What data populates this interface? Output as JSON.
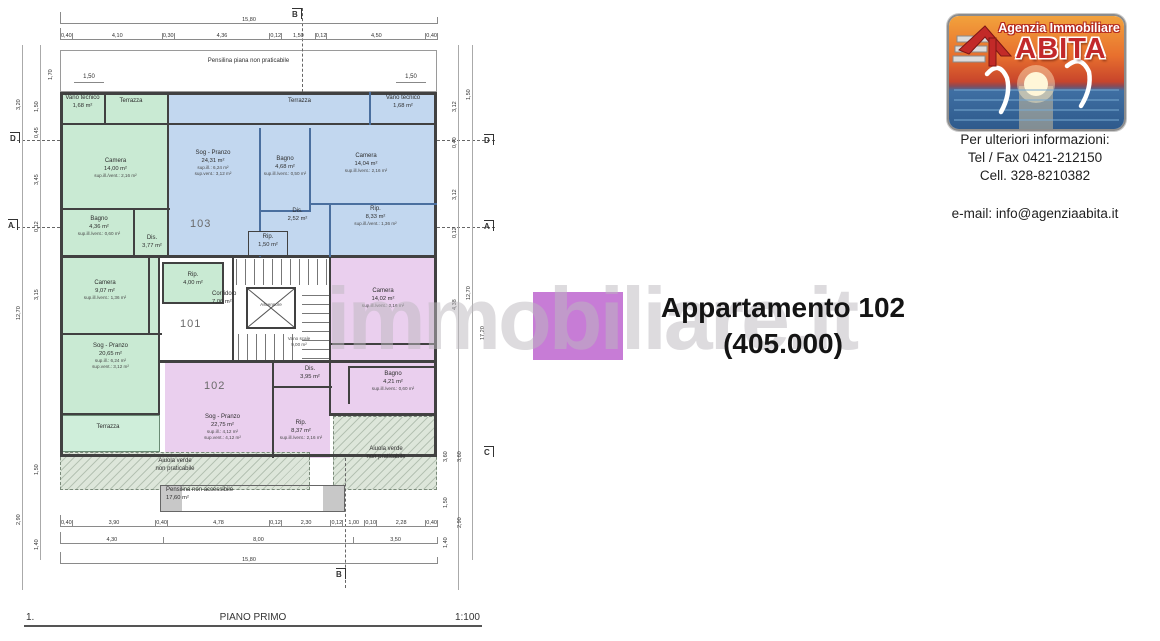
{
  "watermark": "immobiliare.it",
  "listing": {
    "title": "Appartamento 102",
    "price": "(405.000)",
    "swatch_color": "#c77cd6"
  },
  "agency": {
    "name_line1": "Agenzia Immobiliare",
    "name_line2": "ABITA",
    "info_heading": "Per ulteriori informazioni:",
    "phone": "Tel / Fax 0421-212150",
    "mobile": "Cell. 328-8210382",
    "email": "e-mail: info@agenziaabita.it"
  },
  "titleblock": {
    "index": "1.",
    "title": "PIANO PRIMO",
    "scale": "1:100"
  },
  "plan": {
    "colors": {
      "apartment_101": "#c9ead3",
      "apartment_102": "#eacfee",
      "apartment_103": "#c2d7ef",
      "terrace": "#cfeeda",
      "green_area": "#dde6da"
    },
    "apt_numbers": {
      "n101": "101",
      "n102": "102",
      "n103": "103"
    },
    "rooms": [
      {
        "n": "Vano tecnico",
        "a": "1,68 m²"
      },
      {
        "n": "Terrazza"
      },
      {
        "n": "Camera",
        "a": "14,00 m²",
        "s1": "sup.ill./vent.: 2,16 m²"
      },
      {
        "n": "Bagno",
        "a": "4,36 m²",
        "s1": "sup.ill./vent.: 0,60 m²"
      },
      {
        "n": "Dis.",
        "a": "3,77 m²"
      },
      {
        "n": "Camera",
        "a": "9,07 m²",
        "s1": "sup.ill./vent.: 1,36 m²"
      },
      {
        "n": "Rip.",
        "a": "4,00 m²"
      },
      {
        "n": "Sog - Pranzo",
        "a": "20,65 m²",
        "s1": "sup.ill.: 6,24 m²",
        "s2": "sup.vent.: 3,12 m²"
      },
      {
        "n": "Terrazza"
      },
      {
        "n": "Terrazza"
      },
      {
        "n": "Vano tecnico",
        "a": "1,68 m²"
      },
      {
        "n": "Sog - Pranzo",
        "a": "24,31 m²",
        "s1": "sup.ill.: 6,24 m²",
        "s2": "sup.vent.: 3,12 m²"
      },
      {
        "n": "Bagno",
        "a": "4,68 m²",
        "s1": "sup.ill./vent.: 0,50 m²"
      },
      {
        "n": "Camera",
        "a": "14,04 m²",
        "s1": "sup.ill./vent.: 2,16 m²"
      },
      {
        "n": "Dis.",
        "a": "2,52 m²"
      },
      {
        "n": "Rip.",
        "a": "8,33 m²",
        "s1": "sup.ill./vent.: 1,36 m²"
      },
      {
        "n": "Rip.",
        "a": "1,50 m²"
      },
      {
        "n": "Camera",
        "a": "14,02 m²",
        "s1": "sup.ill./vent.: 2,16 m²"
      },
      {
        "n": "Dis.",
        "a": "3,95 m²"
      },
      {
        "n": "Bagno",
        "a": "4,21 m²",
        "s1": "sup.ill./vent.: 0,60 m²"
      },
      {
        "n": "Sog - Pranzo",
        "a": "22,75 m²",
        "s1": "sup.ill.: 4,12 m²",
        "s2": "sup.vent.: 4,12 m²"
      },
      {
        "n": "Rip.",
        "a": "8,37 m²",
        "s1": "sup.ill./vent.: 2,16 m²"
      },
      {
        "n": "Corridoio",
        "a": "7,06 m²"
      },
      {
        "n": "Ascensore"
      },
      {
        "n": "Vano scale",
        "a": "9,00 m²"
      },
      {
        "n": "Aiuola verde",
        "a": "non praticabile"
      },
      {
        "n": "Aiuola verde",
        "a": "non praticabile"
      },
      {
        "n": "Pensilina piana non praticabile"
      },
      {
        "n": "Pensilina non accessibile",
        "a": "17,60 m²"
      }
    ],
    "dims": {
      "overall": "15,80",
      "overall_side": "12,70",
      "top": [
        "0,40",
        "4,10",
        "0,30",
        "4,36",
        "0,12",
        "1,50",
        "0,12",
        "4,50",
        "0,40"
      ],
      "bottom1": [
        "0,40",
        "3,90",
        "0,40",
        "4,78",
        "0,12",
        "2,30",
        "0,12",
        "1,00",
        "0,10",
        "2,28",
        "0,40"
      ],
      "bottom2": [
        "4,30",
        "8,00",
        "3,50"
      ],
      "pensilina": [
        "1,50",
        "1,50",
        "1,70"
      ],
      "left": [
        "3,20",
        "1,50",
        "0,45",
        "3,45",
        "0,12",
        "3,15",
        "12,70",
        "1,50",
        "2,90",
        "1,40"
      ],
      "right": [
        "3,12",
        "1,50",
        "0,40",
        "3,12",
        "0,12",
        "4,38",
        "12,70",
        "17,20",
        "3,60",
        "3,60",
        "1,50",
        "2,90",
        "1,40"
      ]
    },
    "section_markers": {
      "d": "D",
      "a": "A",
      "b": "B",
      "c": "C"
    }
  }
}
